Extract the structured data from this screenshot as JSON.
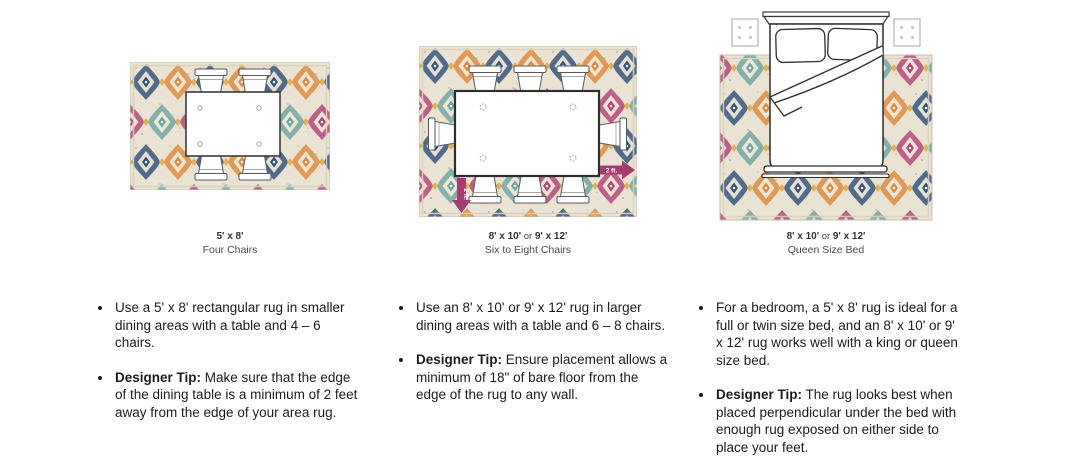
{
  "page": {
    "background": "#ffffff"
  },
  "figures": [
    {
      "name": "dining-small-rug-diagram",
      "caption": {
        "size_a": "5' x 8'",
        "or_word": "",
        "size_b": "",
        "label": "Four Chairs"
      }
    },
    {
      "name": "dining-large-rug-diagram",
      "caption": {
        "size_a": "8' x 10'",
        "or_word": " or ",
        "size_b": "9' x 12'",
        "label": "Six to Eight Chairs"
      },
      "annotations": [
        {
          "text": "2 ft.",
          "direction": "down"
        },
        {
          "text": "2 ft.",
          "direction": "right"
        }
      ]
    },
    {
      "name": "bedroom-rug-diagram",
      "caption": {
        "size_a": "8' x 10'",
        "or_word": " or ",
        "size_b": "9' x 12'",
        "label": "Queen Size Bed"
      }
    }
  ],
  "columns": [
    {
      "bullets": [
        {
          "lead": "",
          "text": "Use a 5' x 8' rectangular rug in smaller dining areas with a table and 4 – 6 chairs."
        },
        {
          "lead": "Designer Tip:",
          "text": " Make sure that the edge of the dining table is a minimum of 2 feet away from the edge of your area rug."
        }
      ]
    },
    {
      "bullets": [
        {
          "lead": "",
          "text": "Use an 8' x 10' or 9' x 12' rug in larger dining areas with a table and 6 – 8 chairs."
        },
        {
          "lead": "Designer Tip:",
          "text": " Ensure placement allows a minimum of 18\" of bare floor from the edge of the rug to any wall."
        }
      ]
    },
    {
      "bullets": [
        {
          "lead": "",
          "text": "For a bedroom, a 5' x 8' rug is ideal for a full or twin size bed, and an 8' x 10' or 9' x 12' rug works well with a king or queen size bed."
        },
        {
          "lead": "Designer Tip:",
          "text": " The rug looks best when placed perpendicular under the bed with enough rug exposed on either side to place your feet."
        }
      ]
    }
  ],
  "rug_colors": {
    "background": "#eae3d4",
    "navy": "#31507b",
    "orange": "#dd8a3f",
    "teal": "#6fa3a0",
    "magenta": "#b24379",
    "gold": "#d9a43c",
    "arrow": "#a63d72"
  }
}
